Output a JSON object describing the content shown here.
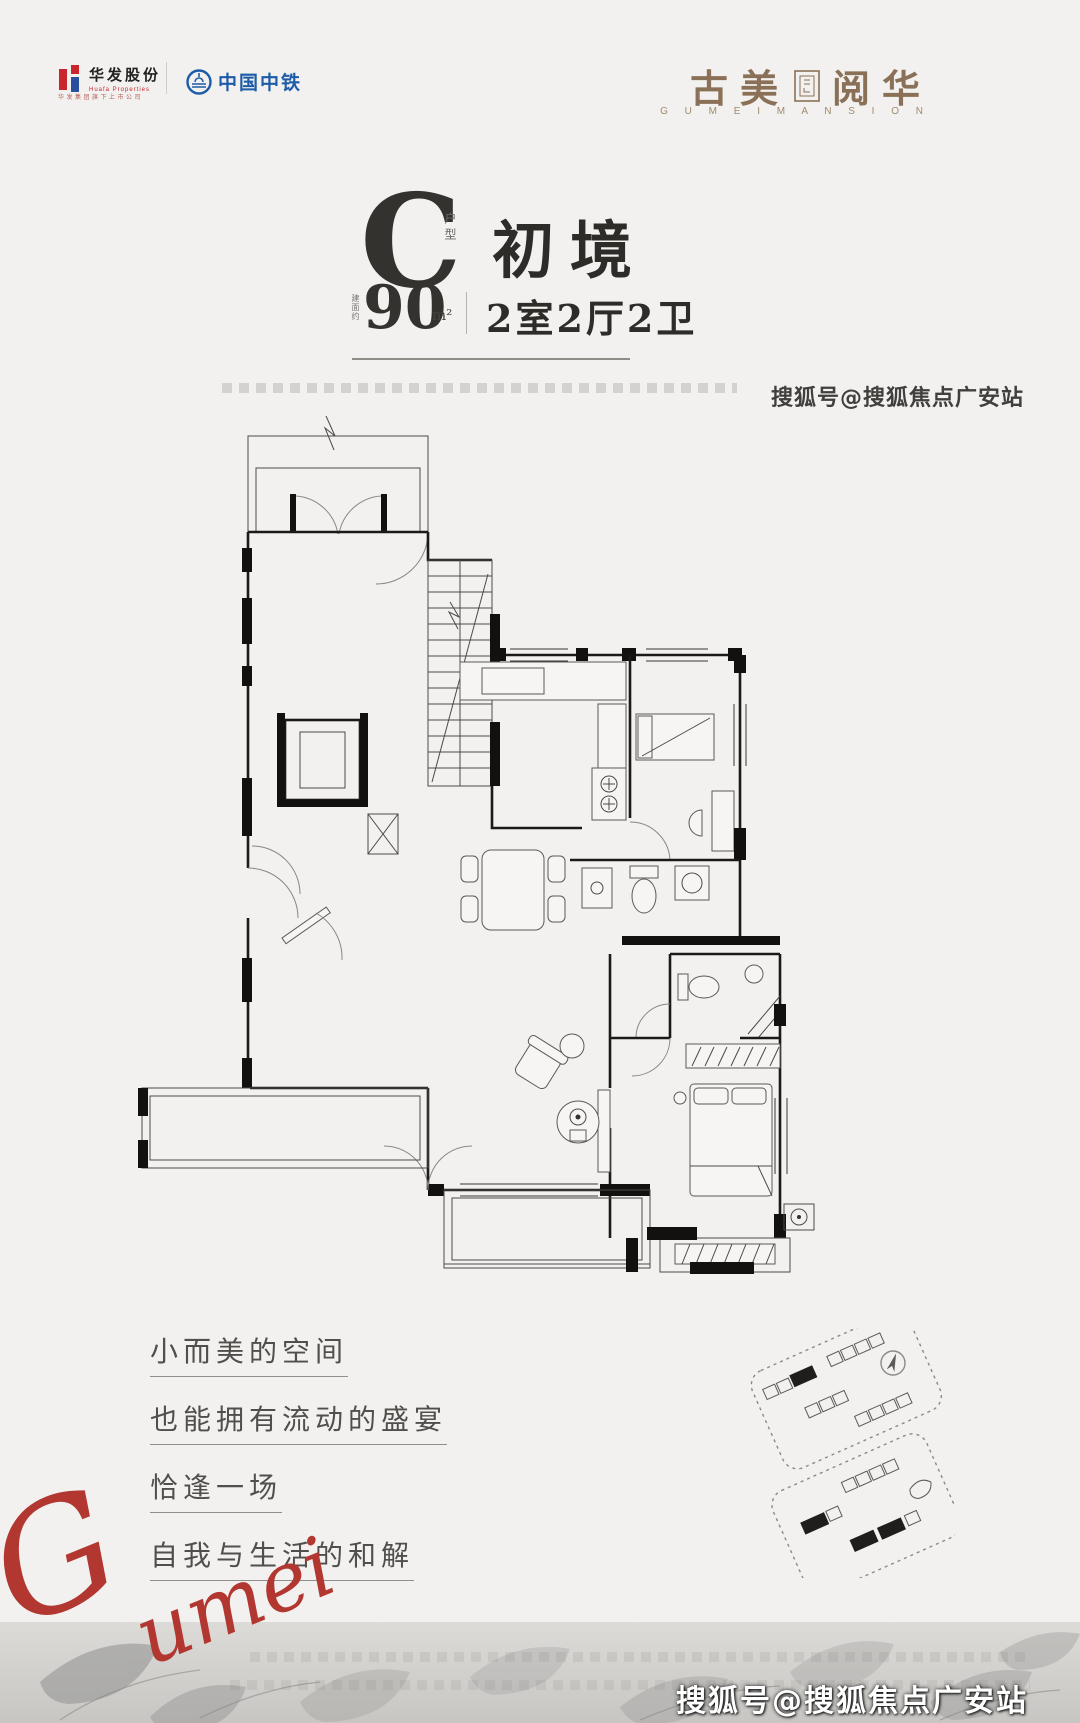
{
  "header": {
    "huafa": {
      "name_cn": "华发股份",
      "name_en": "Huafa Properties",
      "tagline": "华发集团旗下上市公司"
    },
    "crec": {
      "name": "中国中铁"
    }
  },
  "brand": {
    "cn_left": "古美",
    "cn_right": "阅华",
    "en": "G U M E I   M A N S I O N"
  },
  "unit": {
    "type_letter": "C",
    "type_label": "户型",
    "name": "初境",
    "area_prefix": "建面约",
    "area_value": "90",
    "area_unit": "m²",
    "rooms": "2室2厅2卫"
  },
  "slogans": [
    "小而美的空间",
    "也能拥有流动的盛宴",
    "恰逢一场",
    "自我与生活的和解"
  ],
  "signature": {
    "text": "Gumei"
  },
  "watermarks": {
    "top": "搜狐号@搜狐焦点广安站",
    "bottom": "搜狐号@搜狐焦点广安站"
  },
  "colors": {
    "brand_brown": "#8a7057",
    "crec_blue": "#1d5ca8",
    "huafa_red": "#c9252c",
    "signature_red": "#b23730",
    "ink": "#2f2e2c"
  }
}
